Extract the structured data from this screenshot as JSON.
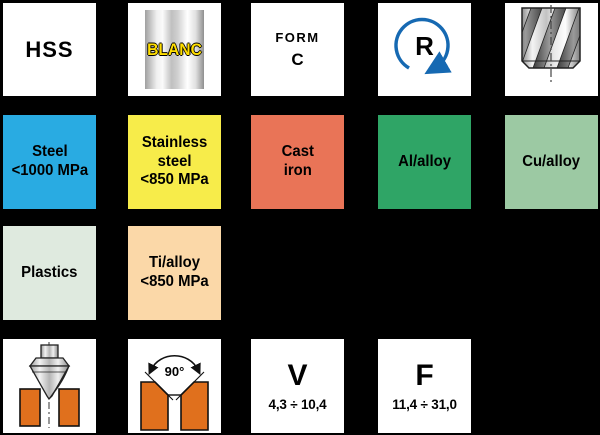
{
  "colors": {
    "background": "#000000",
    "steel": "#29ABE2",
    "stainless_steel": "#F7EC4A",
    "cast_iron": "#E97457",
    "al_alloy": "#2FA566",
    "cu_alloy": "#9CC9A3",
    "plastics": "#DFEADF",
    "ti_alloy": "#FBD8A8",
    "workpiece_orange": "#E0701D",
    "rotation_arrow": "#1669B2",
    "blanc_text": "#FFDE00"
  },
  "tiles": {
    "hss": {
      "label": "HSS"
    },
    "blanc": {
      "label": "BLANC",
      "icon": "cylinder-blank"
    },
    "form_c": {
      "line1": "FORM",
      "line2": "C"
    },
    "rotation": {
      "label": "R",
      "icon": "rotation-right-arrow"
    },
    "drill": {
      "icon": "twist-drill"
    },
    "steel": {
      "line1": "Steel",
      "line2": "<1000 MPa",
      "color": "#29ABE2"
    },
    "stainless": {
      "line1": "Stainless",
      "line2": "steel",
      "line3": "<850 MPa",
      "color": "#F7EC4A"
    },
    "cast_iron": {
      "line1": "Cast",
      "line2": "iron",
      "color": "#E97457"
    },
    "al_alloy": {
      "label": "Al/alloy",
      "color": "#2FA566"
    },
    "cu_alloy": {
      "label": "Cu/alloy",
      "color": "#9CC9A3"
    },
    "plastics": {
      "label": "Plastics",
      "color": "#DFEADF"
    },
    "ti_alloy": {
      "line1": "Ti/alloy",
      "line2": "<850 MPa",
      "color": "#FBD8A8"
    },
    "countersink": {
      "icon": "countersink-tool-in-workpiece"
    },
    "chamfer": {
      "label": "90°",
      "icon": "chamfer-angle-90"
    },
    "cutting_speed": {
      "label": "V",
      "range": "4,3 ÷ 10,4"
    },
    "feed": {
      "label": "F",
      "range": "11,4 ÷ 31,0"
    }
  }
}
